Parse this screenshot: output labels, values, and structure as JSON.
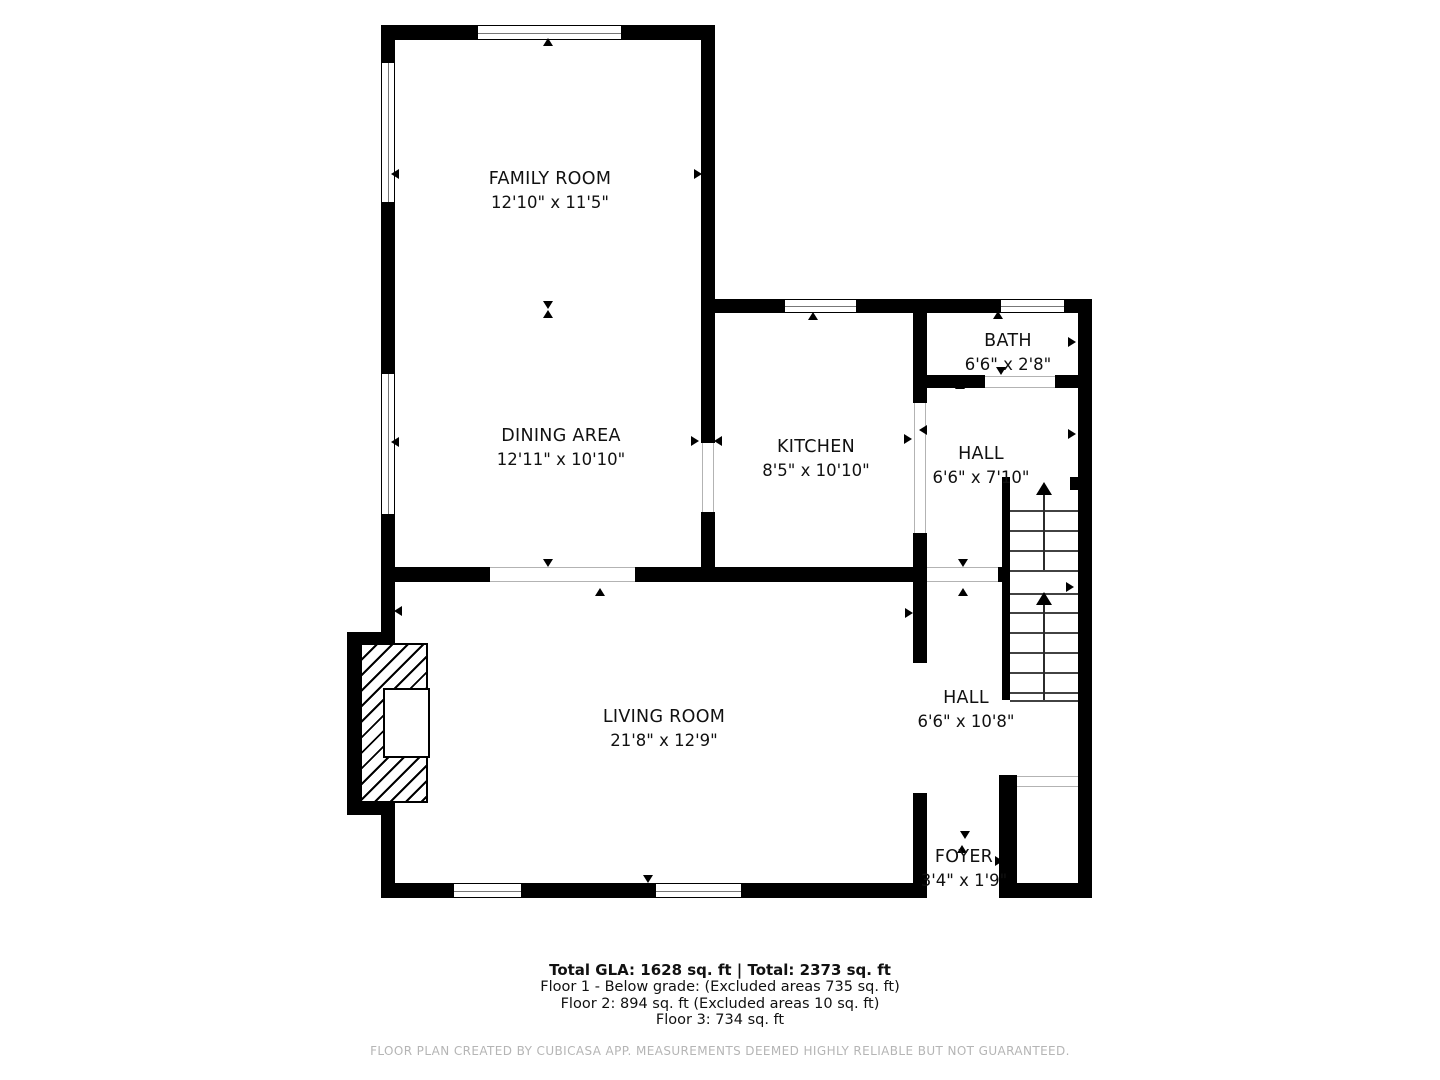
{
  "rooms": [
    {
      "name": "FAMILY ROOM",
      "dims": "12'10\" x 11'5\""
    },
    {
      "name": "DINING AREA",
      "dims": "12'11\" x 10'10\""
    },
    {
      "name": "KITCHEN",
      "dims": "8'5\" x 10'10\""
    },
    {
      "name": "BATH",
      "dims": "6'6\" x 2'8\""
    },
    {
      "name": "HALL",
      "dims": "6'6\" x 7'10\""
    },
    {
      "name": "HALL",
      "dims": "6'6\" x 10'8\""
    },
    {
      "name": "LIVING ROOM",
      "dims": "21'8\" x 12'9\""
    },
    {
      "name": "FOYER",
      "dims": "3'4\" x 1'9\""
    }
  ],
  "summary": {
    "total_line": "Total GLA: 1628 sq. ft | Total: 2373 sq. ft",
    "floor1": "Floor 1 - Below grade: (Excluded areas 735 sq. ft)",
    "floor2": "Floor 2: 894 sq. ft (Excluded areas 10 sq. ft)",
    "floor3": "Floor 3: 734 sq. ft"
  },
  "footer_text": "FLOOR PLAN CREATED BY CUBICASA APP. MEASUREMENTS DEEMED HIGHLY RELIABLE BUT NOT GUARANTEED.",
  "colors": {
    "wall": "#000000",
    "opening_line": "#b3b3b3",
    "stair_tread": "#424242",
    "footer_text": "#b5b5b5",
    "label_text": "#111111",
    "background": "#ffffff"
  }
}
